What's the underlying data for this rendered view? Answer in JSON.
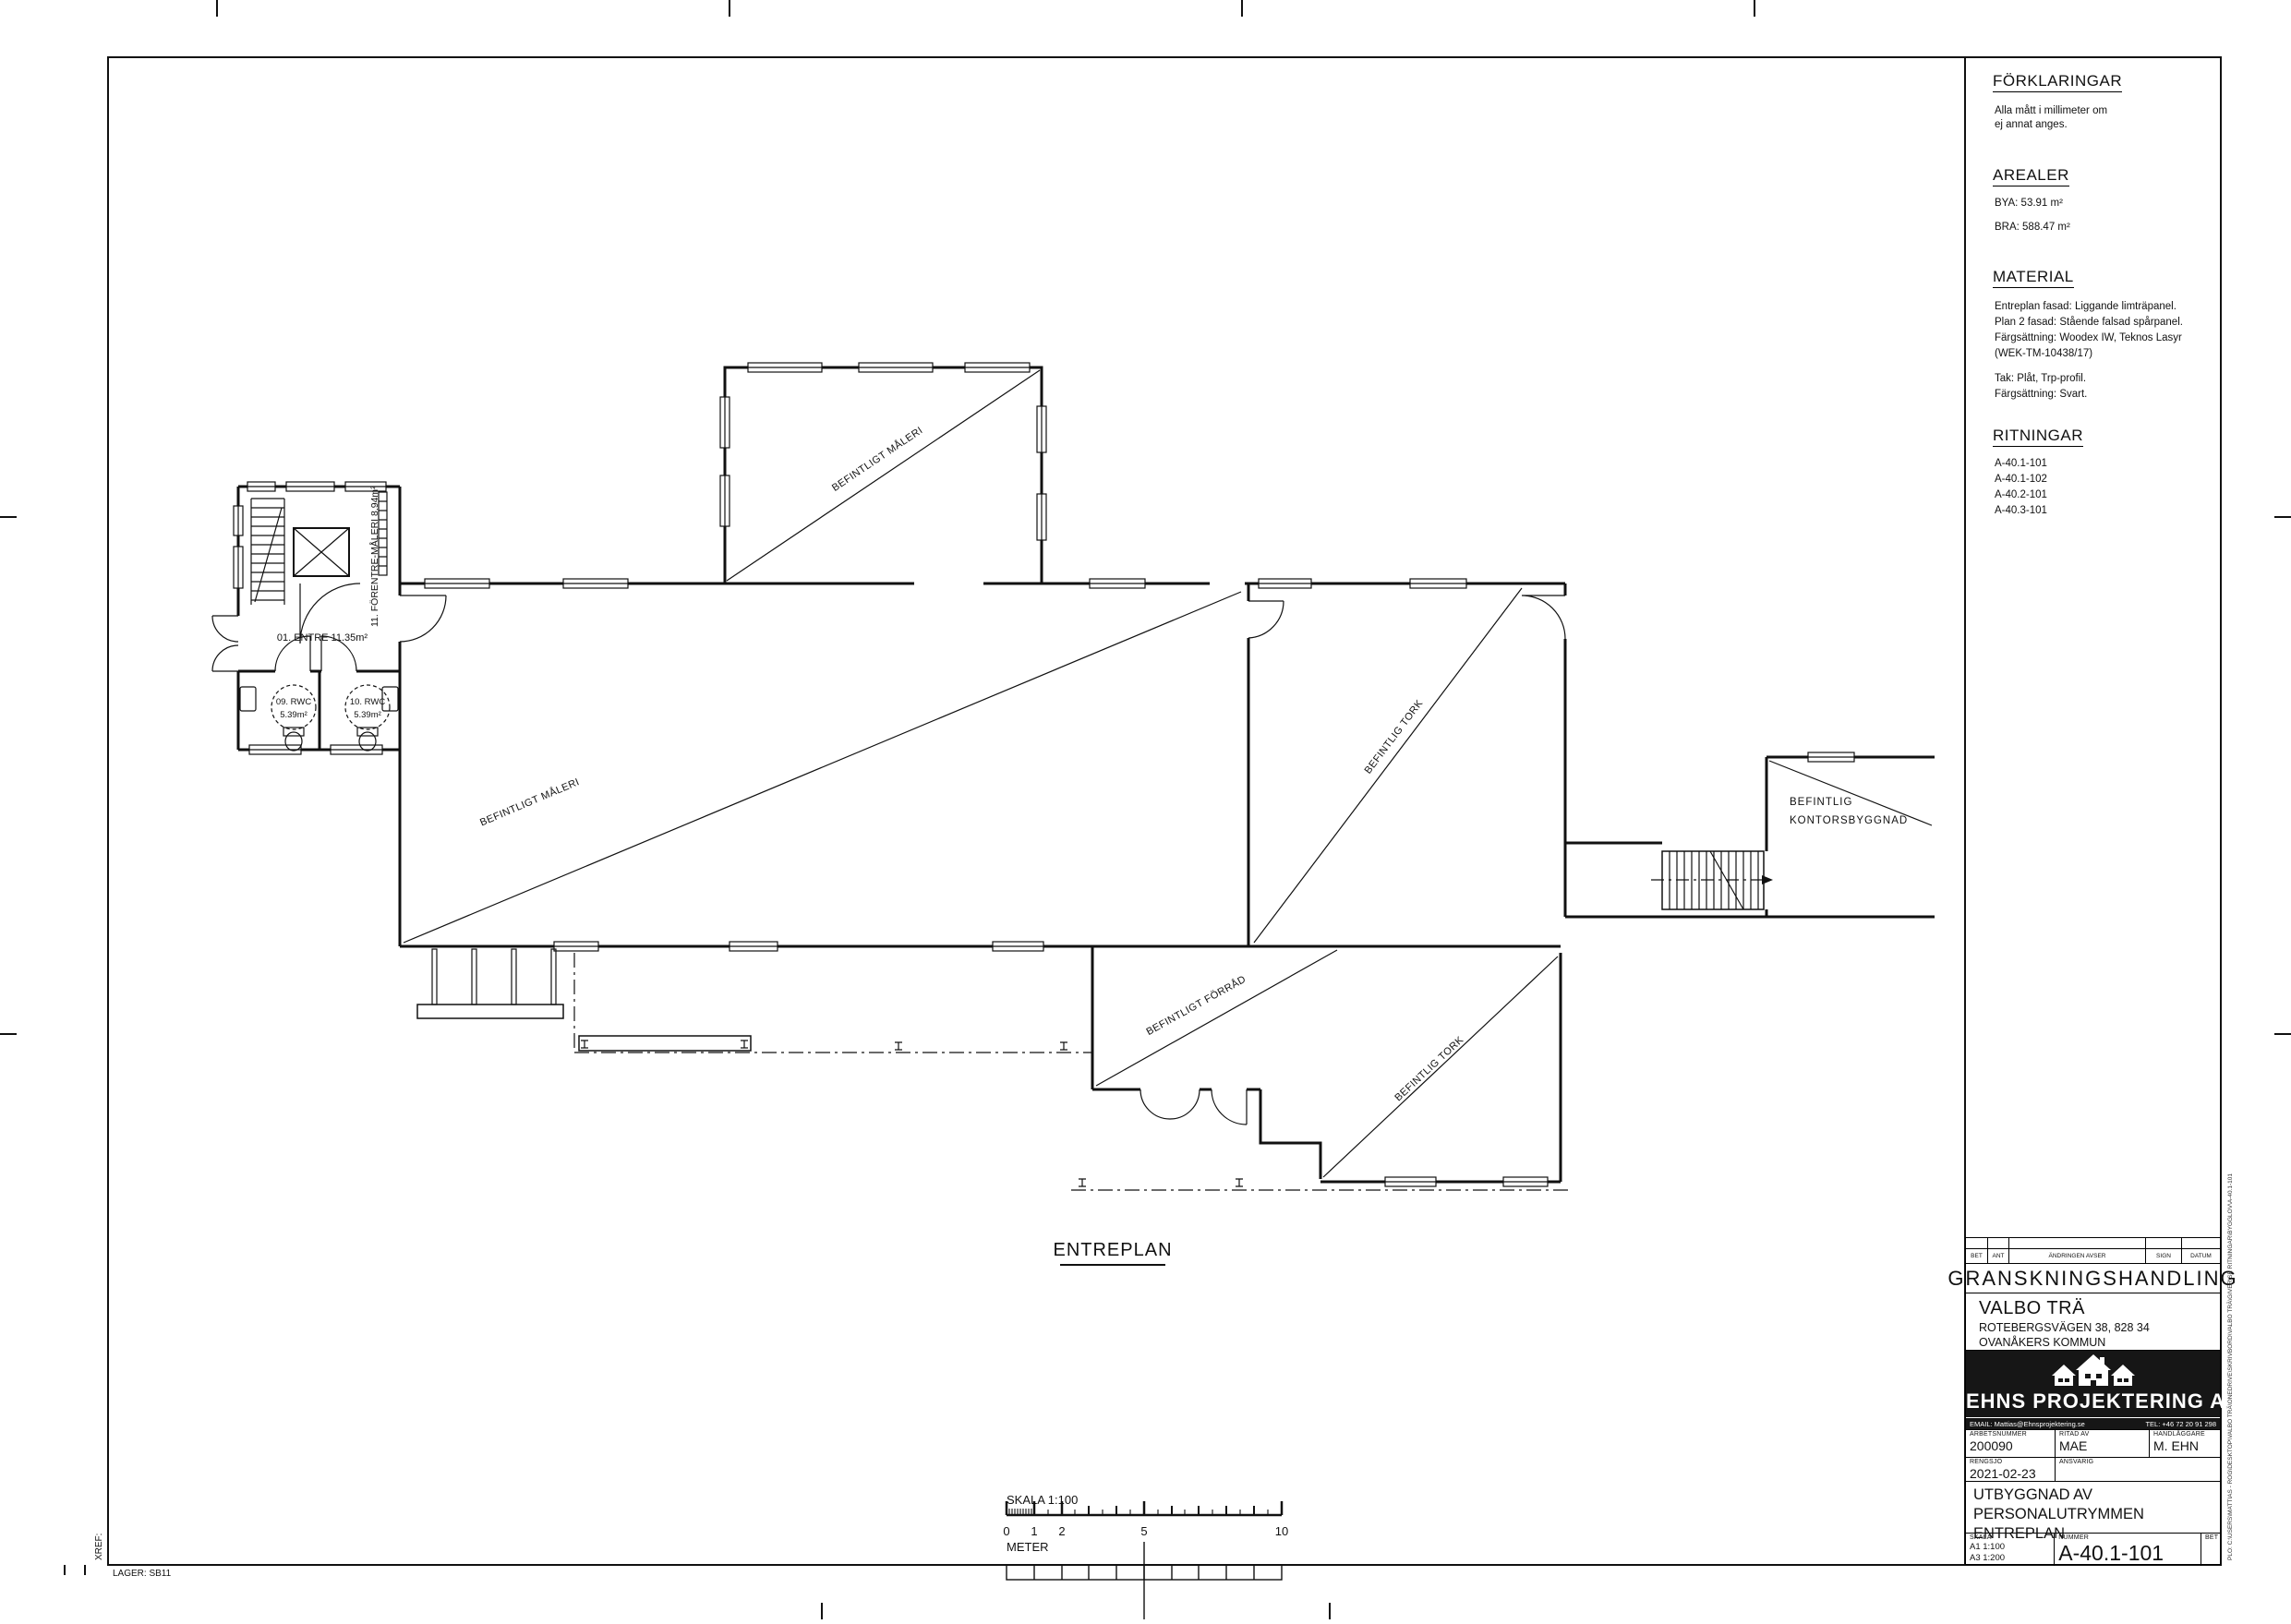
{
  "sheet": {
    "xref": "XREF:",
    "lager": "LAGER: SB11"
  },
  "plan": {
    "title": "ENTREPLAN",
    "labels": {
      "forentre": "11. FÖRENTRE-MÅLERI 8.94m²",
      "entre": "01. ENTRE 11.35m²",
      "rwc09_name": "09. RWC",
      "rwc09_area": "5.39m²",
      "rwc10_name": "10. RWC",
      "rwc10_area": "5.39m²",
      "maleri_upper": "BEFINTLIGT MÅLERI",
      "maleri_main": "BEFINTLIGT MÅLERI",
      "tork_1": "BEFINTLIG TORK",
      "tork_2": "BEFINTLIG TORK",
      "forrad": "BEFINTLIGT FÖRRÅD",
      "kontor_line1": "BEFINTLIG",
      "kontor_line2": "KONTORSBYGGNAD"
    }
  },
  "scalebar": {
    "label": "SKALA 1:100",
    "unit": "METER",
    "ticks": [
      "0",
      "1",
      "2",
      "5",
      "10"
    ]
  },
  "legend": {
    "title": "FÖRKLARINGAR",
    "note_line1": "Alla mått i millimeter om",
    "note_line2": "ej annat anges.",
    "arealer_title": "AREALER",
    "bya": "BYA: 53.91 m²",
    "bra": "BRA: 588.47 m²",
    "material_title": "MATERIAL",
    "material_lines": [
      "Entreplan fasad: Liggande limträpanel.",
      "Plan 2 fasad: Stående falsad spårpanel.",
      "Färgsättning:  Woodex IW, Teknos Lasyr",
      "(WEK-TM-10438/17)",
      "Tak: Plåt, Trp-profil.",
      "Färgsättning: Svart."
    ],
    "ritningar_title": "RITNINGAR",
    "ritningar_items": [
      "A-40.1-101",
      "A-40.1-102",
      "A-40.2-101",
      "A-40.3-101"
    ]
  },
  "titleblock": {
    "rev": {
      "bet": "BET",
      "ant": "ANT",
      "avser": "ÄNDRINGEN AVSER",
      "sign": "SIGN",
      "datum": "DATUM"
    },
    "status": "GRANSKNINGSHANDLING",
    "client_name": "VALBO TRÄ",
    "client_address": "ROTEBERGSVÄGEN 38, 828 34",
    "client_city": "OVANÅKERS KOMMUN",
    "company_name": "EHNS PROJEKTERING AB",
    "company_email": "EMAIL: Mattias@Ehnsprojektering.se",
    "company_tel": "TEL: +46 72 20 91 298",
    "labels": {
      "arbetsnummer": "ARBETSNUMMER",
      "ritad_av": "RITAD AV",
      "handlaggare": "HANDLÄGGARE",
      "rengsjo": "RENGSJÖ",
      "ansvarig": "ANSVARIG",
      "skala": "SKALA",
      "nummer": "NUMMER",
      "bet": "BET"
    },
    "values": {
      "arbetsnummer": "200090",
      "ritad_av": "MAE",
      "handlaggare": "M. EHN",
      "rengsjo_datum": "2021-02-23",
      "ansvarig": "",
      "skala_a1": "A1 1:100",
      "skala_a3": "A3 1:200",
      "nummer": "A-40.1-101",
      "bet": ""
    },
    "project_title_line1": "UTBYGGNAD AV PERSONALUTRYMMEN",
    "project_title_line2": "ENTREPLAN"
  },
  "plot_path": "PLO: C:\\USERS\\MATTIAS - ROG\\DESKTOP\\VALBO TRÄ\\ONEDRIVE\\SKRIVBORD\\VALBO TRÄ\\GIVER\\SE RITNINGAR\\BYGGLOV\\A-40.1-101"
}
